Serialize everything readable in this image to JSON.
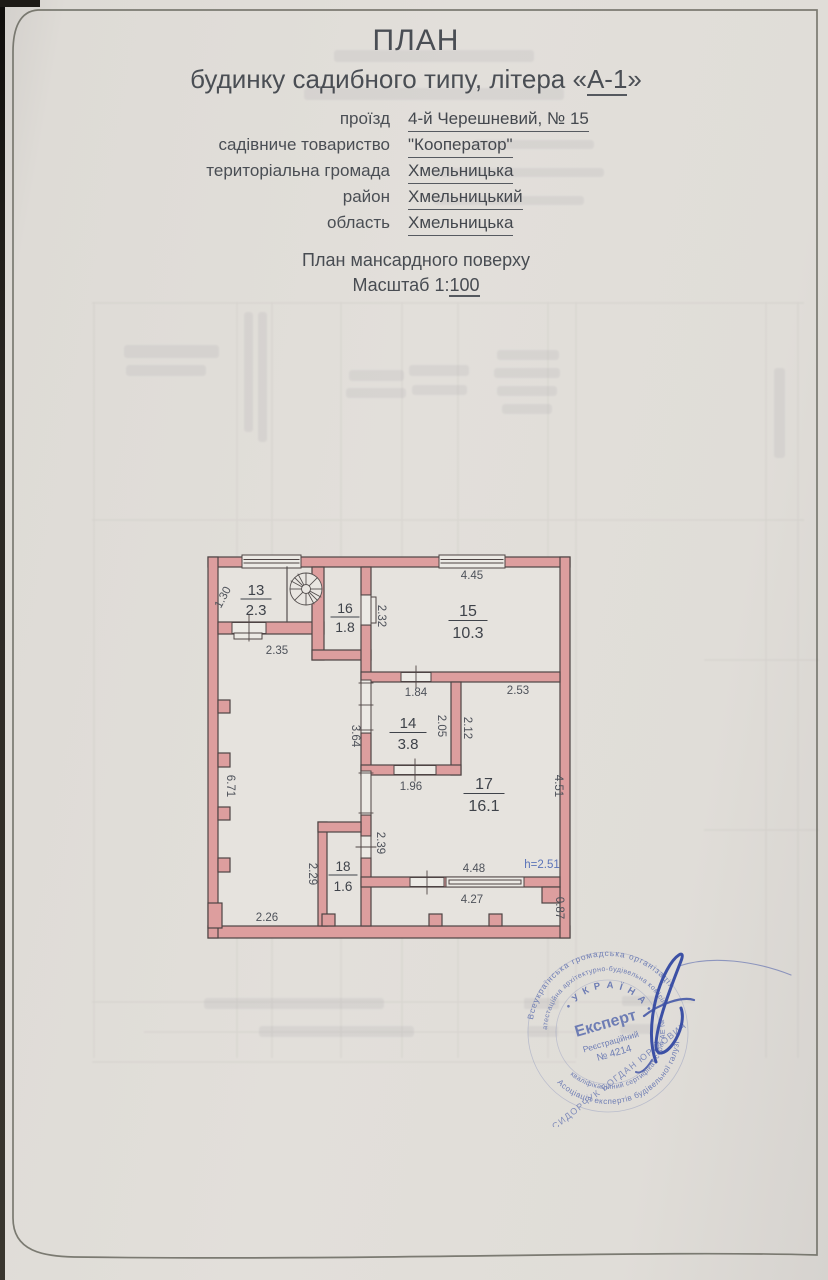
{
  "document": {
    "title": {
      "line1": "ПЛАН",
      "line2_pre": "будинку садибного типу, літера «",
      "line2_value": "А-1",
      "line2_post": "»"
    },
    "address": {
      "rows": [
        {
          "label": "проїзд",
          "value": "4-й Черешневий, № 15"
        },
        {
          "label": "садівниче товариство",
          "value": "\"Кооператор\""
        },
        {
          "label": "територіальна громада",
          "value": "Хмельницька"
        },
        {
          "label": "район",
          "value": "Хмельницький"
        },
        {
          "label": "область",
          "value": "Хмельницька"
        }
      ]
    },
    "subtitle": {
      "line1": "План мансардного поверху",
      "line2_pre": "Масштаб 1:",
      "line2_value": "100"
    }
  },
  "plan": {
    "rooms": [
      {
        "number": "13",
        "area": "2.3"
      },
      {
        "number": "16",
        "area": "1.8"
      },
      {
        "number": "15",
        "area": "10.3"
      },
      {
        "number": "14",
        "area": "3.8"
      },
      {
        "number": "17",
        "area": "16.1"
      },
      {
        "number": "18",
        "area": "1.6"
      }
    ],
    "dims": {
      "d445": "4.45",
      "d130": "1.30",
      "d235": "2.35",
      "d232": "2.32",
      "d184": "1.84",
      "d253": "2.53",
      "d205": "2.05",
      "d212": "2.12",
      "d364": "3.64",
      "d196": "1.96",
      "d451": "4.51",
      "d671": "6.71",
      "d239": "2.39",
      "d229": "2.29",
      "d448": "4.48",
      "d427": "4.27",
      "d087": "0.87",
      "d226": "2.26",
      "height_note": "h=2.51"
    }
  },
  "stamp": {
    "ring_outer_top": "Всеукраїнська громадська організація",
    "ring_outer_bottom": "Асоціація експертів будівельної галузі",
    "ring_mid_top": "атестаційна архітектурно-будівельна комісія",
    "ring_mid_bottom": "кваліфікаційний сертифікат серія АЕ №",
    "country": "• У К Р А Ї Н А •",
    "center_line1": "Експерт",
    "center_line2": "Реєстраційний",
    "center_line3": "№ 4214",
    "expert_name": "СИДОРЧУК БОГДАН ЮРІЙОВИЧ"
  },
  "colors": {
    "paper": "#dfdcd7",
    "wall_fill": "#dd9e9e",
    "wall_stroke": "#4e4444",
    "ink": "#43474d",
    "dim_ink": "#4e525a",
    "blue_note": "#5b74b8",
    "stamp_blue": "#4f63aa",
    "signature_blue": "#3c50a5"
  }
}
